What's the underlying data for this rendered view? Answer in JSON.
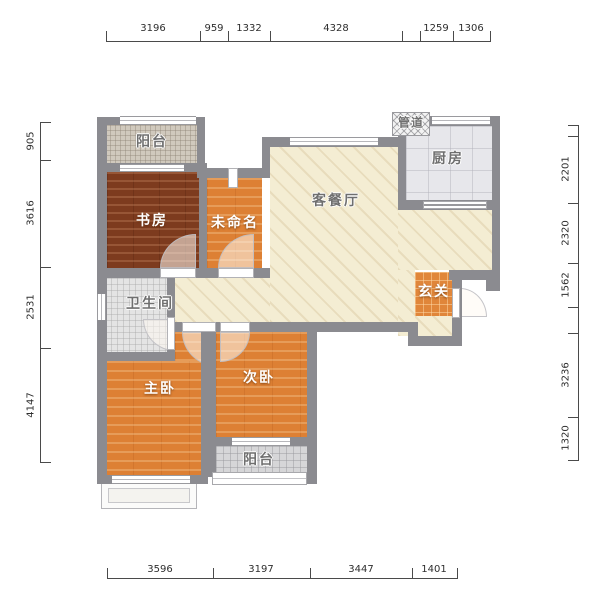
{
  "rooms": {
    "balcony_top": {
      "label": "阳台"
    },
    "study": {
      "label": "书房"
    },
    "unnamed": {
      "label": "未命名"
    },
    "living_dining": {
      "label": "客餐厅"
    },
    "kitchen": {
      "label": "厨房"
    },
    "duct": {
      "label": "管道"
    },
    "entry": {
      "label": "玄关"
    },
    "bathroom": {
      "label": "卫生间"
    },
    "master_bedroom": {
      "label": "主卧"
    },
    "second_bedroom": {
      "label": "次卧"
    },
    "balcony_bottom": {
      "label": "阳台"
    }
  },
  "dimensions_mm": {
    "top": [
      "3196",
      "959",
      "1332",
      "4328",
      "1259",
      "1306"
    ],
    "bottom": [
      "3596",
      "3197",
      "3447",
      "1401"
    ],
    "left": [
      "905",
      "3616",
      "2531",
      "4147"
    ],
    "right": [
      "2201",
      "2320",
      "1562",
      "3236",
      "1320"
    ]
  },
  "colors": {
    "wall": "#8b8b90",
    "study_floor": "#7d3b1e",
    "bedroom_floor": "#dd8034",
    "living_floor": "#f4edd3",
    "entry_tile": "#e0863a"
  }
}
